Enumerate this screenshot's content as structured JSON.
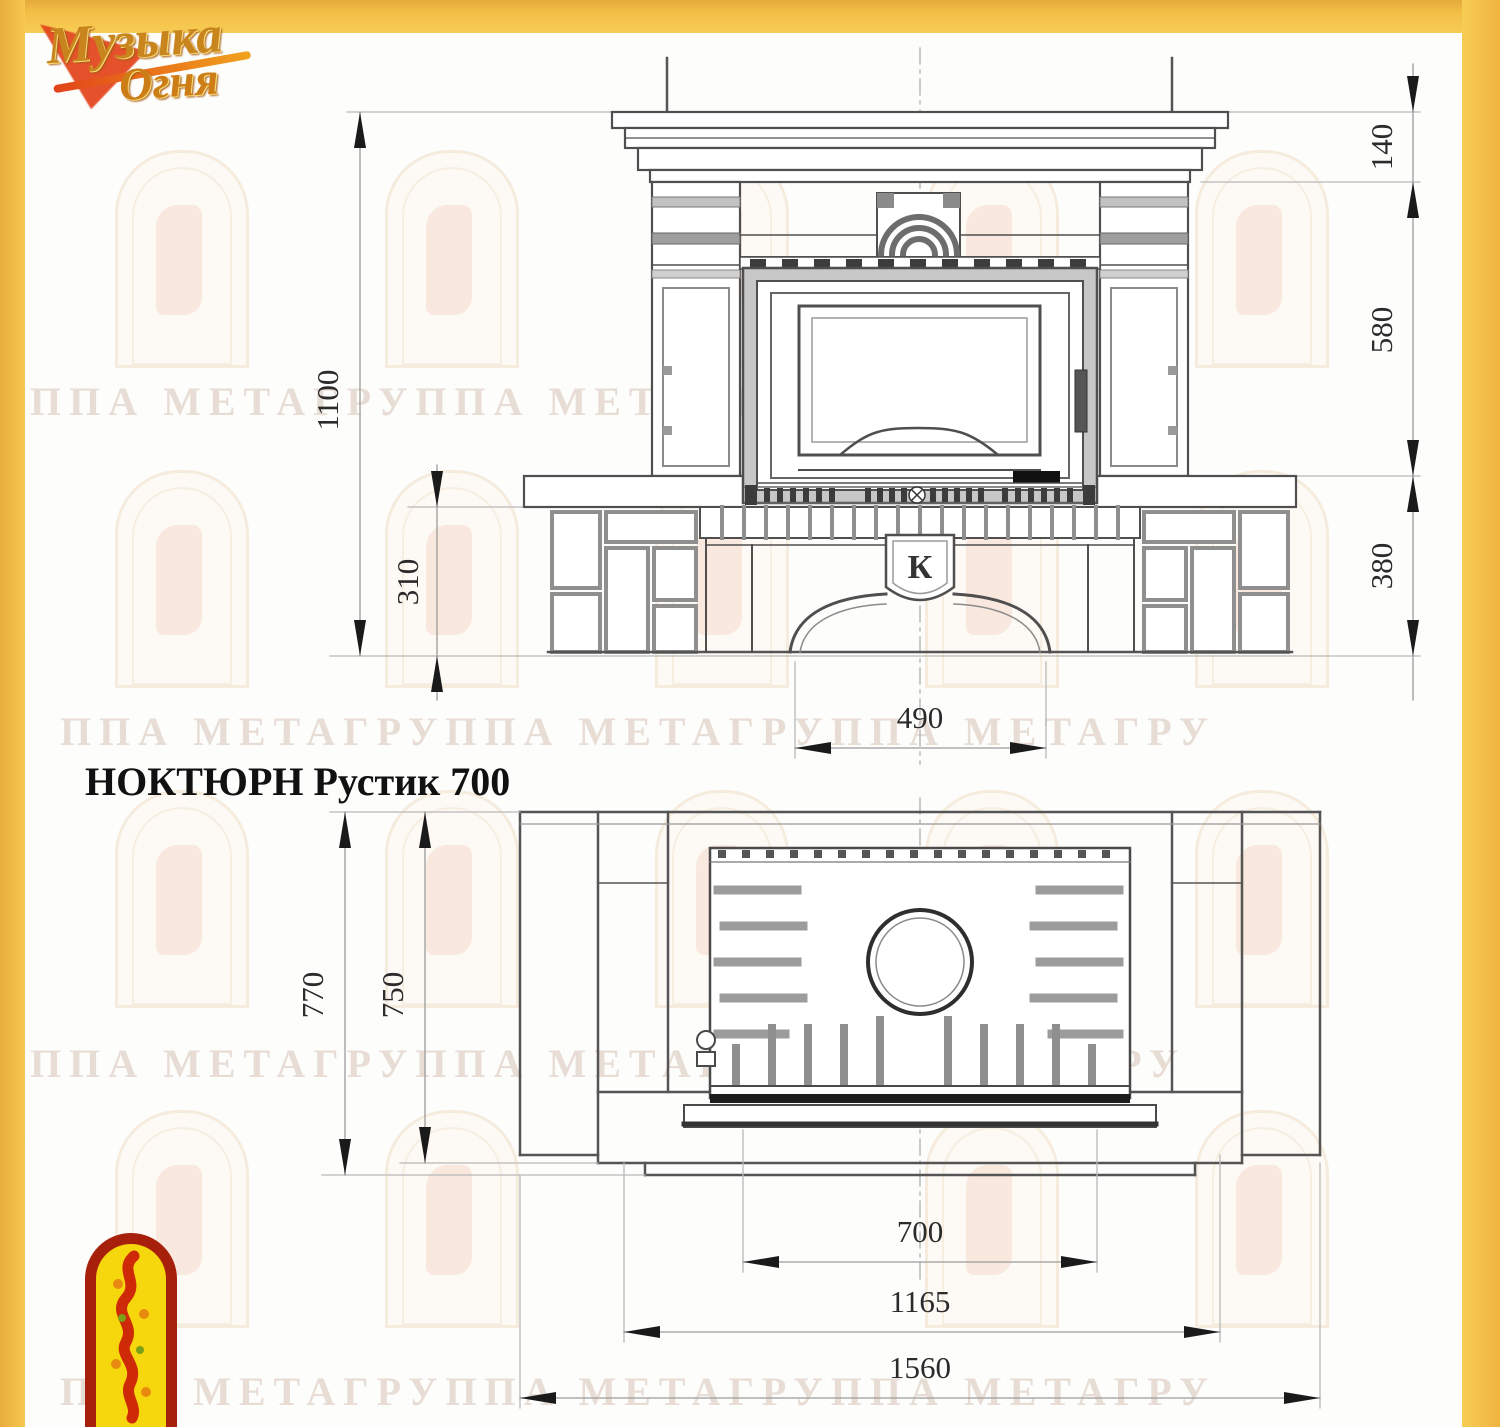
{
  "brand": {
    "logo_line1": "Музыка",
    "logo_line2": "Огня",
    "corner_emblem": "fire-figure-arch-emblem"
  },
  "title": "НОКТЮРН Рустик 700",
  "watermark": {
    "text": "ППА МЕТАГРУППА МЕТАГРУППА МЕТАГРУ"
  },
  "keystone": {
    "letter": "К"
  },
  "views": {
    "front": {
      "name": "front-elevation",
      "dims": {
        "total_height": "1100",
        "mantel_top": "140",
        "middle": "580",
        "base": "380",
        "hearth": "310",
        "opening": "490"
      }
    },
    "plan": {
      "name": "top-plan",
      "dims": {
        "depth_total": "770",
        "depth_inner": "750",
        "firebox_width": "700",
        "body_width": "1165",
        "width_total": "1560"
      }
    }
  },
  "colors": {
    "frame_yellow": "#f2bd45",
    "line_dark": "#4f4f4f",
    "dim_line": "#b5b5b5",
    "fill_gray": "#c7c7c7",
    "slat_dark": "#3c3c3c",
    "emblem_red": "#a7200c",
    "emblem_yellow": "#f6d60c",
    "logo_gold": "#c9851d"
  }
}
